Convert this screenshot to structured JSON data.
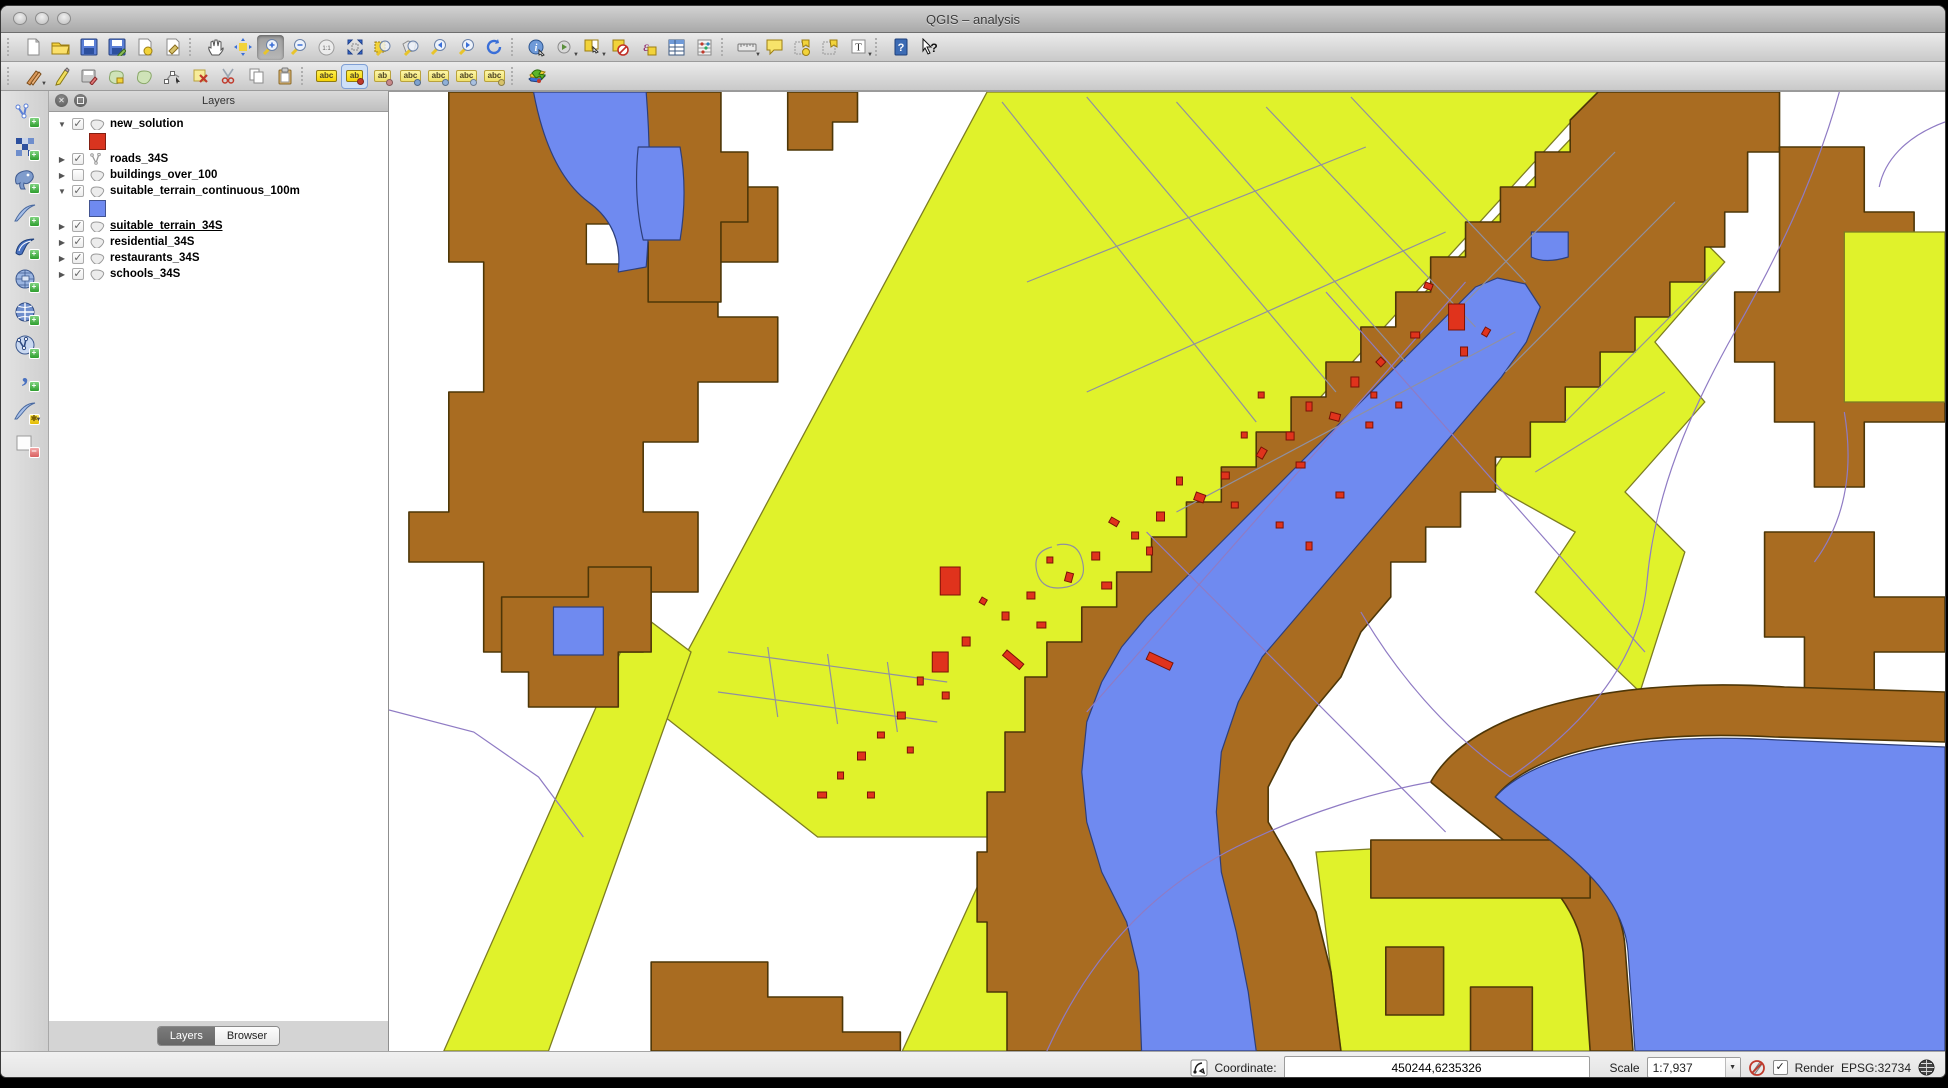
{
  "window": {
    "title": "QGIS  – analysis"
  },
  "glyphs": {
    "check": "✓",
    "dropdown": "▼",
    "plus": "+",
    "minus": "−",
    "star": "✱",
    "zoom_native": "1:1",
    "abc": "abc",
    "ab": "ab",
    "text_annotation": "T",
    "epsilon": "ε",
    "help": "?",
    "whats_this": "?",
    "close": "✕",
    "expanded": "▼",
    "collapsed": "▶",
    "comma": ",",
    "identify": "i"
  },
  "layers_panel": {
    "title": "Layers",
    "layers": [
      {
        "name": "new_solution",
        "checked": true,
        "expanded": true,
        "arrow": "▼",
        "type": "polygon",
        "active": false,
        "swatch": "#d9341f"
      },
      {
        "name": "roads_34S",
        "checked": true,
        "expanded": false,
        "arrow": "▶",
        "type": "line",
        "active": false
      },
      {
        "name": "buildings_over_100",
        "checked": false,
        "expanded": false,
        "arrow": "▶",
        "type": "polygon",
        "active": false
      },
      {
        "name": "suitable_terrain_continuous_100m",
        "checked": true,
        "expanded": true,
        "arrow": "▼",
        "type": "polygon",
        "active": false,
        "swatch": "#6f8af0"
      },
      {
        "name": "suitable_terrain_34S",
        "checked": true,
        "expanded": false,
        "arrow": "▶",
        "type": "polygon",
        "active": true
      },
      {
        "name": "residential_34S",
        "checked": true,
        "expanded": false,
        "arrow": "▶",
        "type": "polygon",
        "active": false
      },
      {
        "name": "restaurants_34S",
        "checked": true,
        "expanded": false,
        "arrow": "▶",
        "type": "polygon",
        "active": false
      },
      {
        "name": "schools_34S",
        "checked": true,
        "expanded": false,
        "arrow": "▶",
        "type": "polygon",
        "active": false
      }
    ],
    "tabs": [
      {
        "label": "Layers",
        "active": true
      },
      {
        "label": "Browser",
        "active": false
      }
    ]
  },
  "status_bar": {
    "coordinate_label": "Coordinate:",
    "coordinate_value": "450244,6235326",
    "scale_label": "Scale",
    "scale_value": "1:7,937",
    "render_label": "Render",
    "epsg_label": "EPSG:32734"
  },
  "map": {
    "colors": {
      "yellow": "#e0f22b",
      "yellow_dark": "#7d7d22",
      "brown": "#a96c21",
      "brown_dark": "#4d3607",
      "blue": "#6f8af0",
      "blue_dark": "#2e3f7a",
      "red": "#e0331c",
      "red_dark": "#7a1206",
      "road_gray": "#9090a0",
      "road_purple": "#8f7bc4",
      "swatch_red": "#d9341f",
      "swatch_blue": "#6f8af0"
    },
    "buildings": [
      [
        1063,
        212,
        16,
        26,
        0
      ],
      [
        1040,
        190,
        8,
        6,
        20
      ],
      [
        1075,
        255,
        7,
        9,
        0
      ],
      [
        1100,
        235,
        6,
        8,
        30
      ],
      [
        1025,
        240,
        9,
        6,
        0
      ],
      [
        995,
        265,
        7,
        7,
        45
      ],
      [
        965,
        285,
        8,
        10,
        0
      ],
      [
        985,
        300,
        6,
        6,
        0
      ],
      [
        945,
        320,
        10,
        7,
        15
      ],
      [
        920,
        310,
        6,
        9,
        0
      ],
      [
        900,
        340,
        8,
        8,
        0
      ],
      [
        875,
        355,
        7,
        10,
        30
      ],
      [
        855,
        340,
        6,
        6,
        0
      ],
      [
        910,
        370,
        9,
        6,
        0
      ],
      [
        835,
        380,
        8,
        7,
        0
      ],
      [
        810,
        400,
        10,
        8,
        20
      ],
      [
        790,
        385,
        6,
        8,
        0
      ],
      [
        845,
        410,
        7,
        6,
        0
      ],
      [
        770,
        420,
        8,
        9,
        0
      ],
      [
        745,
        440,
        7,
        7,
        0
      ],
      [
        725,
        425,
        9,
        6,
        30
      ],
      [
        760,
        455,
        6,
        8,
        0
      ],
      [
        705,
        460,
        8,
        8,
        0
      ],
      [
        680,
        480,
        7,
        9,
        15
      ],
      [
        660,
        465,
        6,
        6,
        0
      ],
      [
        715,
        490,
        10,
        7,
        0
      ],
      [
        640,
        500,
        8,
        7,
        0
      ],
      [
        615,
        520,
        7,
        8,
        0
      ],
      [
        595,
        505,
        6,
        6,
        30
      ],
      [
        650,
        530,
        9,
        6,
        0
      ],
      [
        575,
        545,
        8,
        9,
        0
      ],
      [
        553,
        475,
        20,
        28,
        0
      ],
      [
        545,
        560,
        16,
        20,
        0
      ],
      [
        620,
        558,
        22,
        7,
        40
      ],
      [
        555,
        600,
        7,
        7,
        0
      ],
      [
        530,
        585,
        6,
        8,
        0
      ],
      [
        510,
        620,
        8,
        7,
        0
      ],
      [
        490,
        640,
        7,
        6,
        0
      ],
      [
        520,
        655,
        6,
        6,
        0
      ],
      [
        470,
        660,
        8,
        8,
        0
      ],
      [
        450,
        680,
        6,
        7,
        0
      ],
      [
        480,
        700,
        7,
        6,
        0
      ],
      [
        430,
        700,
        9,
        6,
        0
      ],
      [
        890,
        430,
        7,
        6,
        0
      ],
      [
        920,
        450,
        6,
        8,
        0
      ],
      [
        950,
        400,
        8,
        6,
        0
      ],
      [
        763,
        560,
        26,
        8,
        25
      ],
      [
        980,
        330,
        7,
        6,
        0
      ],
      [
        1010,
        310,
        6,
        6,
        0
      ],
      [
        872,
        300,
        6,
        6,
        0
      ]
    ]
  }
}
